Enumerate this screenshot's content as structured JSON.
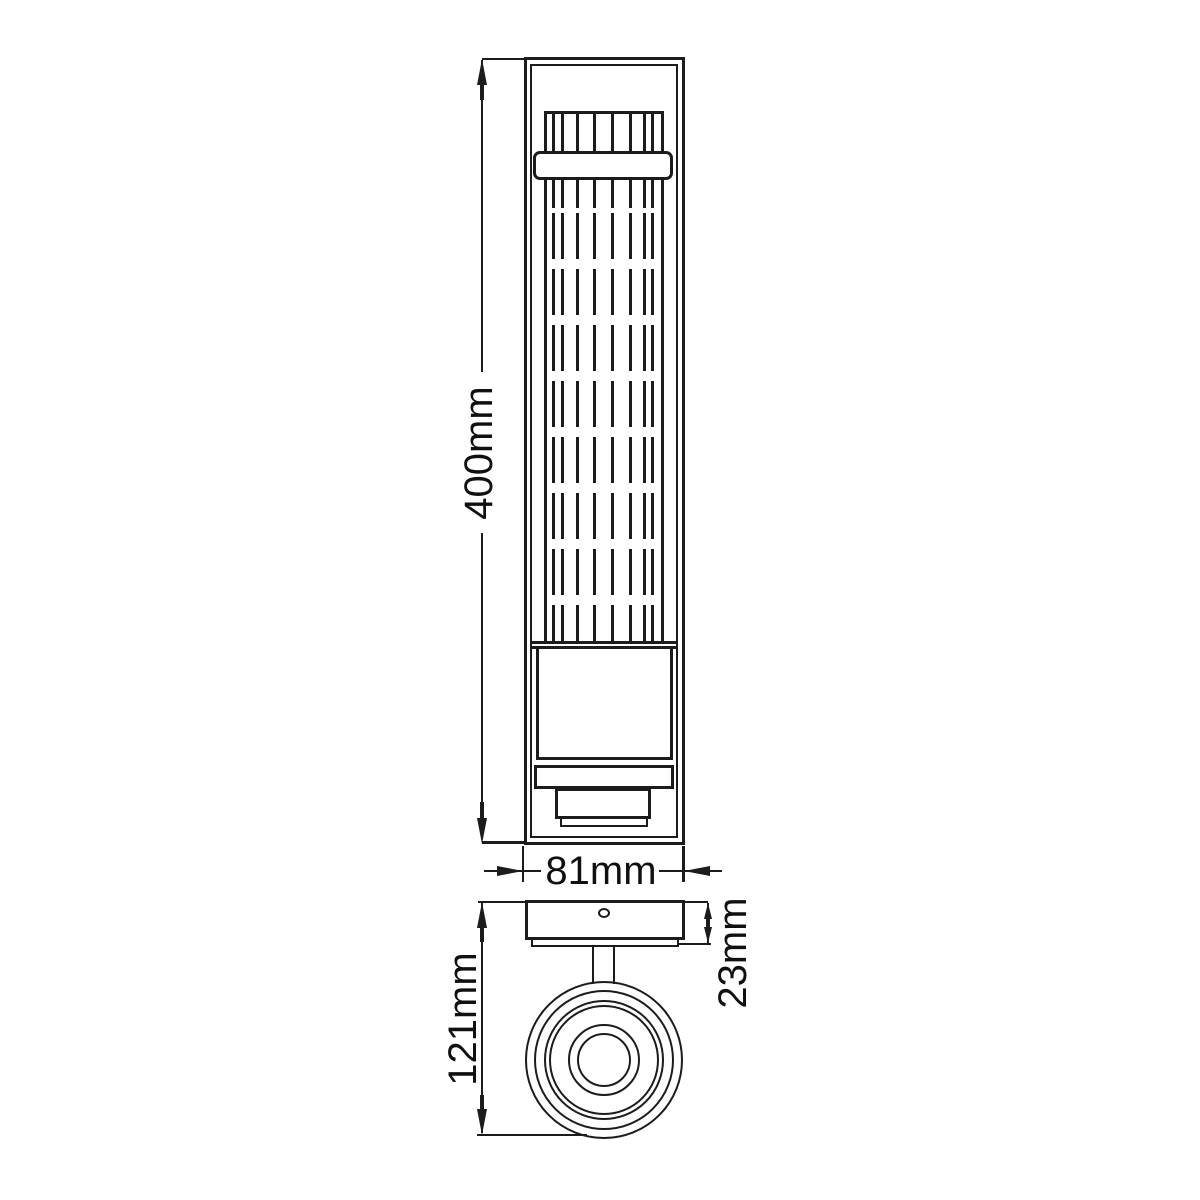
{
  "page": {
    "background": "#ffffff"
  },
  "diagram": {
    "type": "technical dimension drawing",
    "subject": "wall light fixture with ribbed glass shade, front and side views",
    "line_color": "#1c1c1c",
    "views": [
      {
        "id": "front",
        "name": "front elevation"
      },
      {
        "id": "side",
        "name": "side profile"
      }
    ],
    "dimensions": {
      "height": {
        "label": "400mm",
        "value": 400,
        "unit": "mm",
        "view": "front"
      },
      "width": {
        "label": "81mm",
        "value": 81,
        "unit": "mm",
        "view": "front"
      },
      "projection": {
        "label": "121mm",
        "value": 121,
        "unit": "mm",
        "view": "side"
      },
      "backplate": {
        "label": "23mm",
        "value": 23,
        "unit": "mm",
        "view": "side"
      }
    }
  }
}
